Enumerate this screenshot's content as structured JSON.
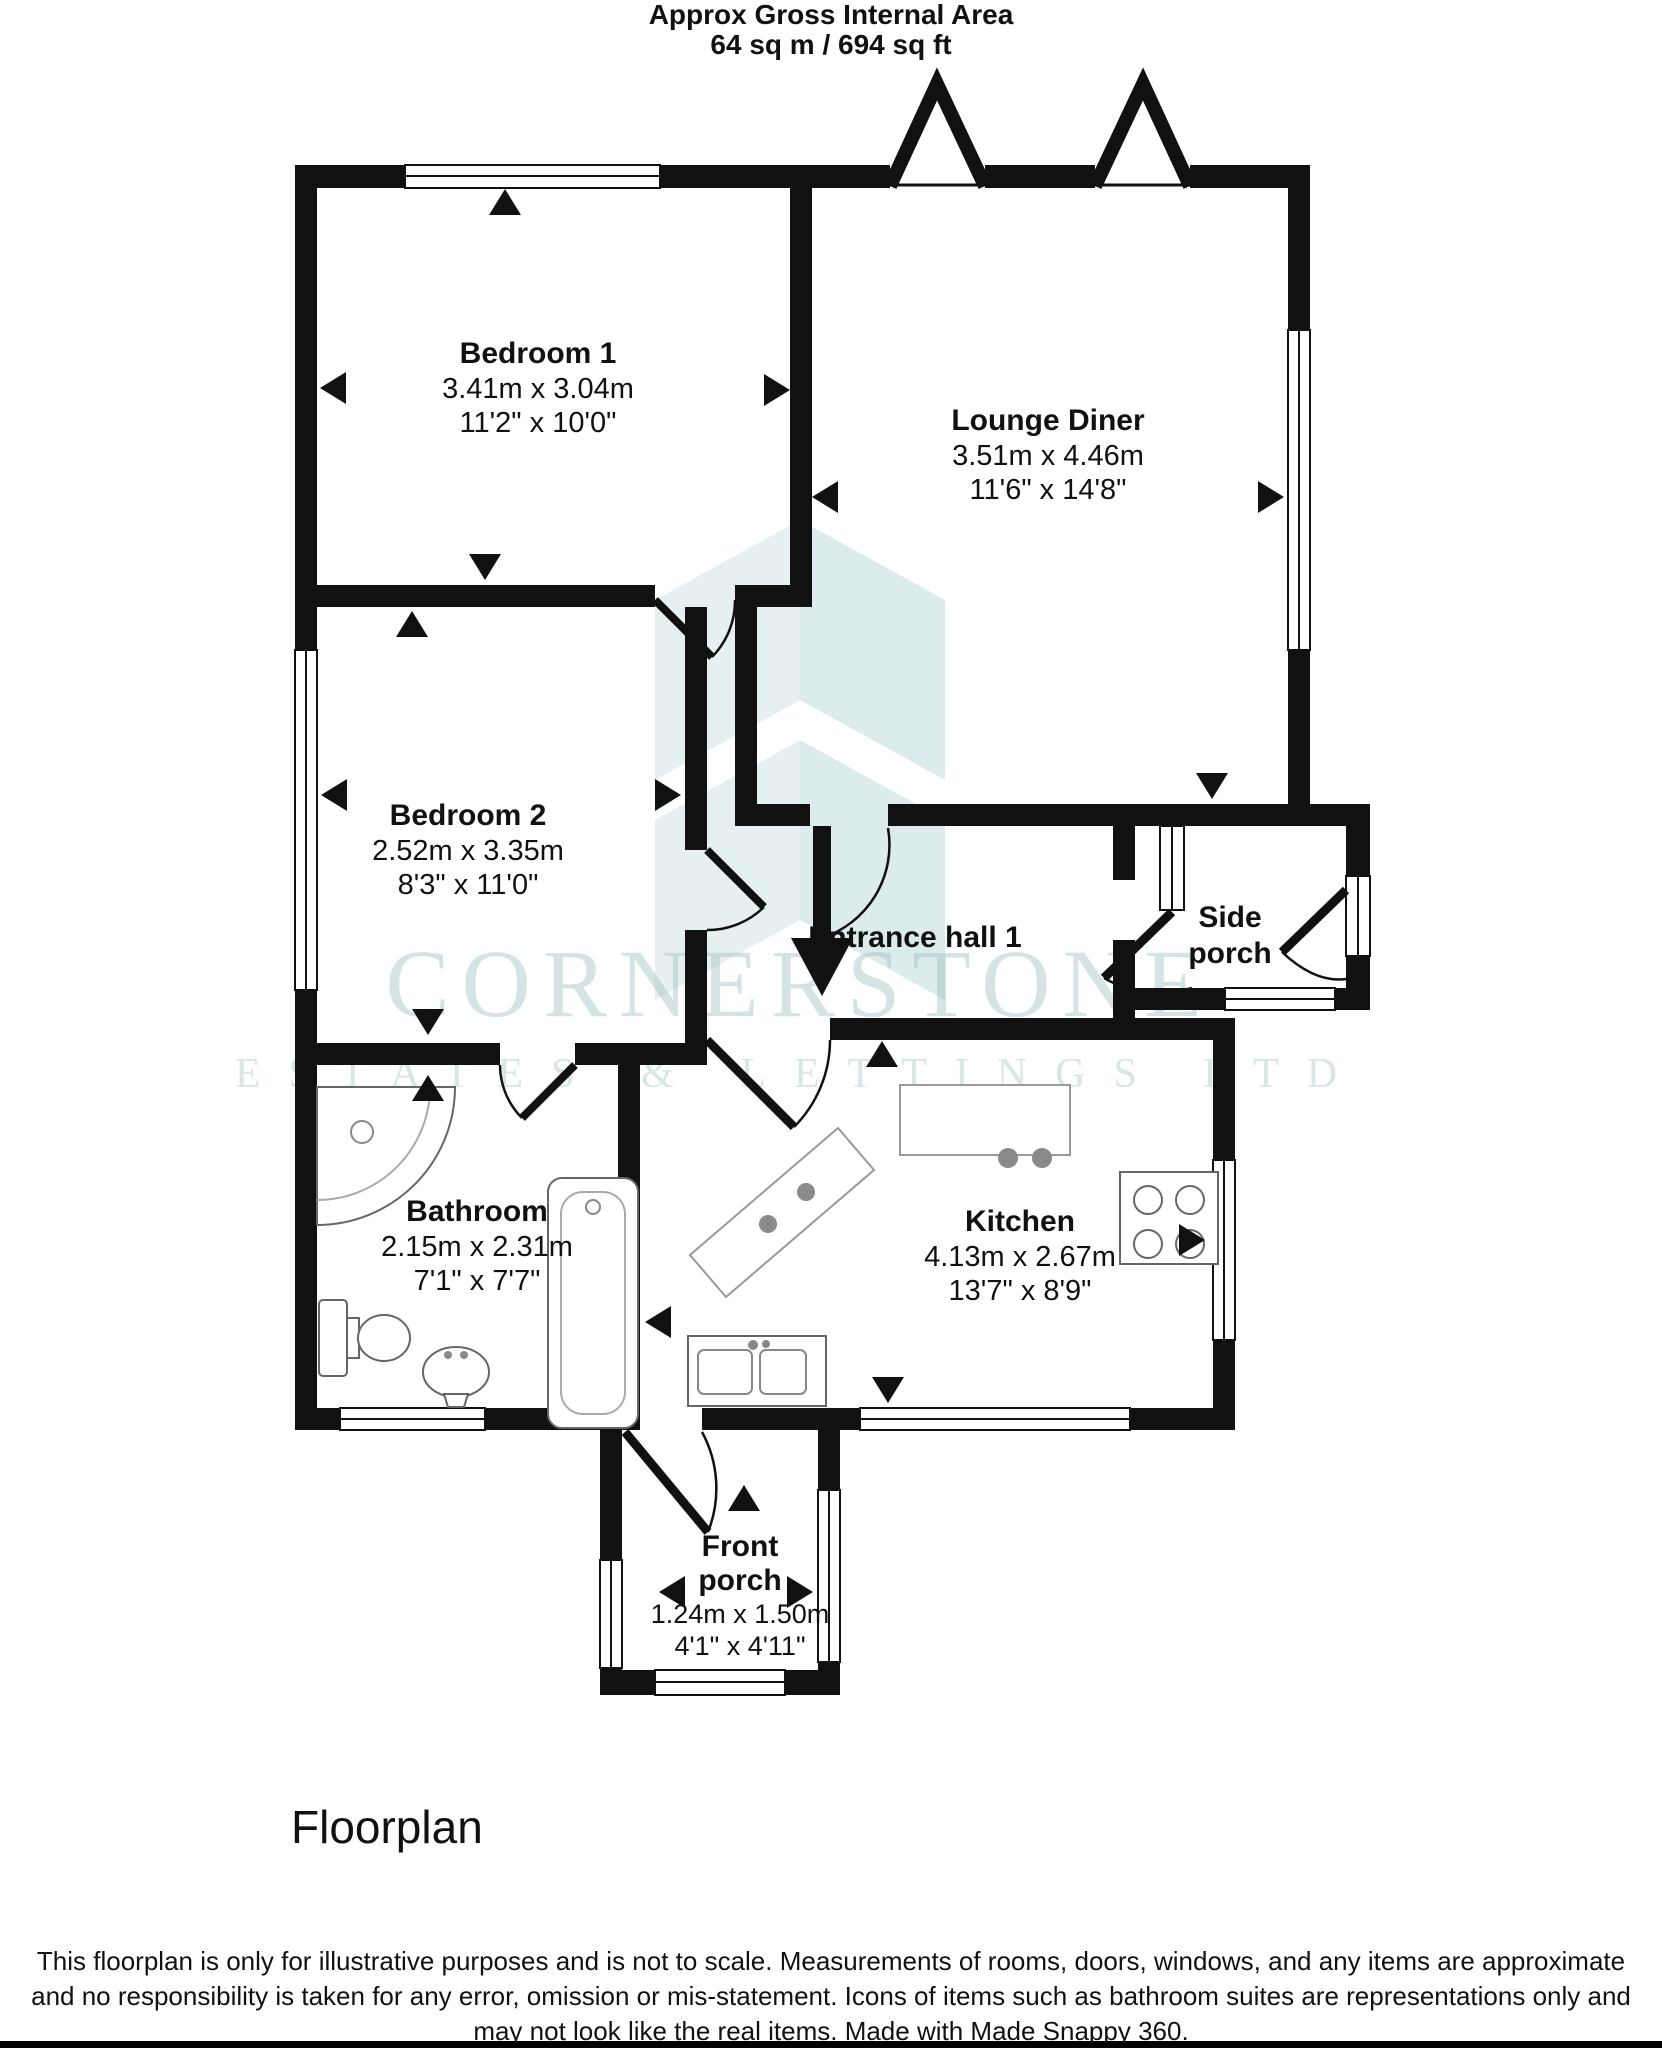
{
  "header": {
    "line1": "Approx Gross Internal Area",
    "line2": "64 sq m / 694 sq ft"
  },
  "rooms": {
    "bedroom1": {
      "name": "Bedroom 1",
      "metric": "3.41m x 3.04m",
      "imperial": "11'2\" x 10'0\""
    },
    "lounge": {
      "name": "Lounge Diner",
      "metric": "3.51m x 4.46m",
      "imperial": "11'6\" x 14'8\""
    },
    "bedroom2": {
      "name": "Bedroom 2",
      "metric": "2.52m x 3.35m",
      "imperial": "8'3\" x 11'0\""
    },
    "hall": {
      "name": "Entrance hall 1"
    },
    "sideporch": {
      "line1": "Side",
      "line2": "porch"
    },
    "bathroom": {
      "name": "Bathroom",
      "metric": "2.15m x 2.31m",
      "imperial": "7'1\" x 7'7\""
    },
    "kitchen": {
      "name": "Kitchen",
      "metric": "4.13m x 2.67m",
      "imperial": "13'7\" x 8'9\""
    },
    "frontporch": {
      "line1": "Front",
      "line2": "porch",
      "metric": "1.24m x 1.50m",
      "imperial": "4'1\" x 4'11\""
    }
  },
  "watermark": {
    "line1": "CORNERSTONE",
    "line2": "ESTATES & LETTINGS LTD"
  },
  "caption": "Floorplan",
  "disclaimer": {
    "line1": "This floorplan is only for illustrative purposes and is not to scale. Measurements of rooms, doors, windows, and any items are approximate",
    "line2": "and no responsibility is taken for any error, omission or mis-statement. Icons of items such as bathroom suites are representations only and",
    "line3": "may not look like the real items. Made with Made Snappy 360."
  },
  "colors": {
    "wall": "#111111",
    "watermark": "#dce9e9"
  }
}
